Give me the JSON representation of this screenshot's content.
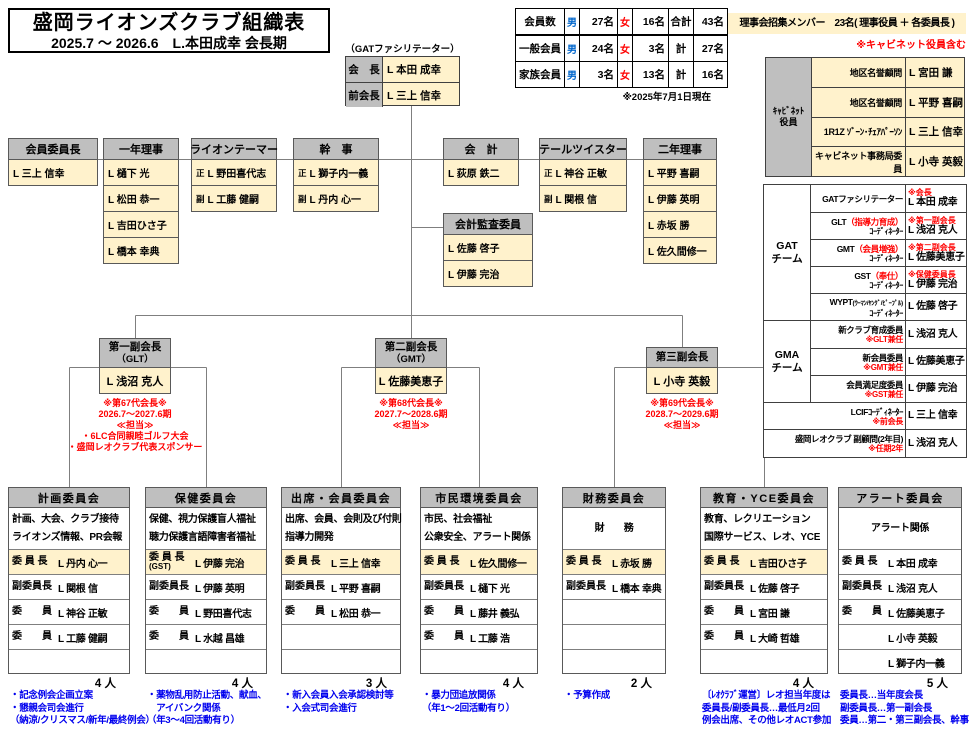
{
  "title": {
    "line1": "盛岡ライオンズクラブ組織表",
    "line2": "2025.7 ～ 2026.6　L.本田成幸 会長期"
  },
  "president": {
    "note": "（GATファシリテーター）",
    "rows": [
      {
        "label": "会　長",
        "name": "L 本田 成幸"
      },
      {
        "label": "前会長",
        "name": "L 三上 信幸"
      }
    ]
  },
  "members": {
    "header": {
      "label": "会員数",
      "m": "男",
      "m_v": "27名",
      "f": "女",
      "f_v": "16名",
      "t": "合計",
      "t_v": "43名"
    },
    "rows": [
      {
        "label": "一般会員",
        "m": "男",
        "m_v": "24名",
        "f": "女",
        "f_v": "3名",
        "t": "計",
        "t_v": "27名"
      },
      {
        "label": "家族会員",
        "m": "男",
        "m_v": "3名",
        "f": "女",
        "f_v": "13名",
        "t": "計",
        "t_v": "16名"
      }
    ],
    "asof": "※2025年7月1日現在"
  },
  "board": {
    "banner": "理事会招集メンバー　23名( 理事役員 ＋ 各委員長 )",
    "note": "※キャビネット役員含む"
  },
  "cabinet": {
    "label1": "ｷｬﾋﾞﾈｯﾄ",
    "label2": "役員",
    "rows": [
      {
        "role": "地区名誉顧問",
        "name": "L 宮田 謙"
      },
      {
        "role": "地区名誉顧問",
        "name": "L 平野 喜嗣"
      },
      {
        "role": "1R1Z ｿﾞｰﾝ･ﾁｪｱﾊﾟｰｿﾝ",
        "name": "L 三上 信幸"
      },
      {
        "role": "キャビネット事務局委員",
        "name": "L 小寺 英毅"
      }
    ]
  },
  "officers": [
    {
      "title": "会員委員長",
      "rows": [
        {
          "name": "L 三上 信幸"
        }
      ]
    },
    {
      "title": "一年理事",
      "rows": [
        {
          "name": "L 樋下 光"
        },
        {
          "name": "L 松田 恭一"
        },
        {
          "name": "L 吉田ひさ子"
        },
        {
          "name": "L 橋本 幸典"
        }
      ]
    },
    {
      "title": "ライオンテーマー",
      "rows": [
        {
          "pre": "正",
          "name": "L 野田喜代志"
        },
        {
          "pre": "副",
          "name": "L 工藤 健嗣"
        }
      ]
    },
    {
      "title": "幹　事",
      "rows": [
        {
          "pre": "正",
          "name": "L 獅子内一義"
        },
        {
          "pre": "副",
          "name": "L 丹内 心一"
        }
      ]
    },
    {
      "title": "会　計",
      "rows": [
        {
          "name": "L 荻原 鉄二"
        }
      ]
    },
    {
      "title": "テールツイスター",
      "rows": [
        {
          "pre": "正",
          "name": "L 神谷 正敏"
        },
        {
          "pre": "副",
          "name": "L 関根 信"
        }
      ]
    },
    {
      "title": "二年理事",
      "rows": [
        {
          "name": "L 平野 喜嗣"
        },
        {
          "name": "L 伊藤 英明"
        },
        {
          "name": "L 赤坂 勝"
        },
        {
          "name": "L 佐久間修一"
        }
      ]
    }
  ],
  "audit": {
    "title": "会計監査委員",
    "rows": [
      {
        "name": "L 佐藤 啓子"
      },
      {
        "name": "L 伊藤 完治"
      }
    ]
  },
  "vps": [
    {
      "title": "第一副会長",
      "sub": "（GLT）",
      "name": "L 浅沼 克人",
      "notes": [
        "※第67代会長※",
        "2026.7～2027.6期",
        "≪担当≫",
        "・6LC合同親睦ゴルフ大会",
        "・盛岡レオクラブ代表スポンサー"
      ]
    },
    {
      "title": "第二副会長",
      "sub": "（GMT）",
      "name": "L 佐藤美恵子",
      "notes": [
        "※第68代会長※",
        "2027.7～2028.6期",
        "≪担当≫"
      ]
    },
    {
      "title": "第三副会長",
      "sub": "",
      "name": "L 小寺 英毅",
      "notes": [
        "※第69代会長※",
        "2028.7～2029.6期",
        "≪担当≫"
      ]
    }
  ],
  "gat": {
    "gat_label1": "GAT",
    "gat_label2": "チーム",
    "gma_label1": "GMA",
    "gma_label2": "チーム",
    "gat_rows": [
      {
        "role": "GATファシリテーター",
        "role_red": "",
        "role_small": "",
        "role2": "",
        "note": "※会長",
        "name": "L 本田 成幸"
      },
      {
        "role": "GLT",
        "role_red": "（指導力育成）",
        "role_small": "",
        "role2": "ｺｰﾃﾞｨﾈｰﾀｰ",
        "note": "※第一副会長",
        "name": "L 浅沼 克人"
      },
      {
        "role": "GMT",
        "role_red": "（会員増強）",
        "role_small": "",
        "role2": "ｺｰﾃﾞｨﾈｰﾀｰ",
        "note": "※第二副会長",
        "name": "L 佐藤美恵子"
      },
      {
        "role": "GST",
        "role_red": "（奉仕）",
        "role_small": "",
        "role2": "ｺｰﾃﾞｨﾈｰﾀｰ",
        "note": "※保健委員長",
        "name": "L 伊藤 完治"
      },
      {
        "role": "WYPT",
        "role_red": "",
        "role_small": "(ｳｰﾏﾝ/ﾔﾝｸﾞ/ﾋﾟｰﾌﾟﾙ)",
        "role2": "ｺｰﾃﾞｨﾈｰﾀｰ",
        "note": "",
        "name": "L 佐藤 啓子"
      }
    ],
    "gma_rows": [
      {
        "role": "新クラブ育成委員",
        "note2": "※GLT兼任",
        "name": "L 浅沼 克人"
      },
      {
        "role": "新会員委員",
        "note2": "※GMT兼任",
        "name": "L 佐藤美恵子"
      },
      {
        "role": "会員満足度委員",
        "note2": "※GST兼任",
        "name": "L 伊藤 完治"
      }
    ],
    "extra_rows": [
      {
        "role": "LCIFｺｰﾃﾞｨﾈｰﾀｰ",
        "note2": "※前会長",
        "name": "L 三上 信幸"
      },
      {
        "role": "盛岡レオクラブ 副顧問(2年目)",
        "note2": "※任期2年",
        "name": "L 浅沼 克人"
      }
    ]
  },
  "committees": [
    {
      "title": "計画委員会",
      "desc1": "計画、大会、クラブ接待",
      "desc2": "ライオンズ情報、PR会報",
      "rows": [
        {
          "label": "委 員 長",
          "name": "L 丹内 心一"
        },
        {
          "label": "副委員長",
          "name": "L 関根 信"
        },
        {
          "label": "委　　員",
          "name": "L 神谷 正敏"
        },
        {
          "label": "委　　員",
          "name": "L 工藤 健嗣"
        },
        {
          "label": "",
          "name": ""
        }
      ],
      "count": "4 人",
      "notes": [
        "・記念例会企画立案",
        "・懇親会司会進行",
        "（納涼/クリスマス/新年/最終例会）"
      ]
    },
    {
      "title": "保健委員会",
      "desc1": "保健、視力保護盲人福祉",
      "desc2": "聴力保護言語障害者福祉",
      "rows": [
        {
          "label": "委 員 長",
          "label2": "(GST)",
          "name": "L 伊藤 完治"
        },
        {
          "label": "副委員長",
          "name": "L 伊藤 英明"
        },
        {
          "label": "委　　員",
          "name": "L 野田喜代志"
        },
        {
          "label": "委　　員",
          "name": "L 水越 昌雄"
        },
        {
          "label": "",
          "name": ""
        }
      ],
      "count": "4 人",
      "notes": [
        "・薬物乱用防止活動、献血、",
        "　アイバンク関係",
        "（年3～4回活動有り）"
      ]
    },
    {
      "title": "出席・会員委員会",
      "desc1": "出席、会員、会則及び付則",
      "desc2": "指導力開発",
      "rows": [
        {
          "label": "委 員 長",
          "name": "L 三上 信幸"
        },
        {
          "label": "副委員長",
          "name": "L 平野 喜嗣"
        },
        {
          "label": "委　　員",
          "name": "L 松田 恭一"
        },
        {
          "label": "",
          "name": ""
        },
        {
          "label": "",
          "name": ""
        }
      ],
      "count": "3 人",
      "notes": [
        "・新入会員入会承認検討等",
        "・入会式司会進行"
      ]
    },
    {
      "title": "市民環境委員会",
      "desc1": "市民、社会福祉",
      "desc2": "公衆安全、アラート関係",
      "rows": [
        {
          "label": "委 員 長",
          "name": "L 佐久間修一"
        },
        {
          "label": "副委員長",
          "name": "L 樋下 光"
        },
        {
          "label": "委　　員",
          "name": "L 藤井 義弘"
        },
        {
          "label": "委　　員",
          "name": "L 工藤 浩"
        },
        {
          "label": "",
          "name": ""
        }
      ],
      "count": "4 人",
      "notes": [
        "・暴力団追放関係",
        "（年1～2回活動有り）"
      ]
    },
    {
      "title": "財務委員会",
      "desc_center": "財　　務",
      "rows": [
        {
          "label": "委 員 長",
          "name": "L 赤坂 勝"
        },
        {
          "label": "副委員長",
          "name": "L 橋本 幸典"
        },
        {
          "label": "",
          "name": ""
        },
        {
          "label": "",
          "name": ""
        },
        {
          "label": "",
          "name": ""
        }
      ],
      "count": "2 人",
      "notes": [
        "・予算作成"
      ]
    },
    {
      "title": "教育・YCE委員会",
      "desc1": "教育、レクリエーション",
      "desc2": "国際サービス、レオ、YCE",
      "rows": [
        {
          "label": "委 員 長",
          "name": "L 吉田ひさ子"
        },
        {
          "label": "副委員長",
          "name": "L 佐藤 啓子"
        },
        {
          "label": "委　　員",
          "name": "L 宮田 謙"
        },
        {
          "label": "委　　員",
          "name": "L 大崎 哲雄"
        },
        {
          "label": "",
          "name": ""
        }
      ],
      "count": "4 人",
      "notes": [
        "〔ﾚｵｸﾗﾌﾞ運営〕レオ担当年度は",
        "委員長/副委員長…最低月2回",
        "例会出席、その他レオACT参加"
      ]
    },
    {
      "title": "アラート委員会",
      "desc_center": "アラート関係",
      "rows": [
        {
          "label": "委 員 長",
          "name": "L 本田 成幸"
        },
        {
          "label": "副委員長",
          "name": "L 浅沼 克人"
        },
        {
          "label": "委　　員",
          "name": "L 佐藤美恵子"
        },
        {
          "label": "",
          "name": "L 小寺 英毅"
        },
        {
          "label": "",
          "name": "L 獅子内一義"
        }
      ],
      "count": "5 人",
      "notes": [
        "委員長…当年度会長",
        "副委員長…第一副会長",
        "委員…第二・第三副会長、幹事"
      ]
    }
  ]
}
